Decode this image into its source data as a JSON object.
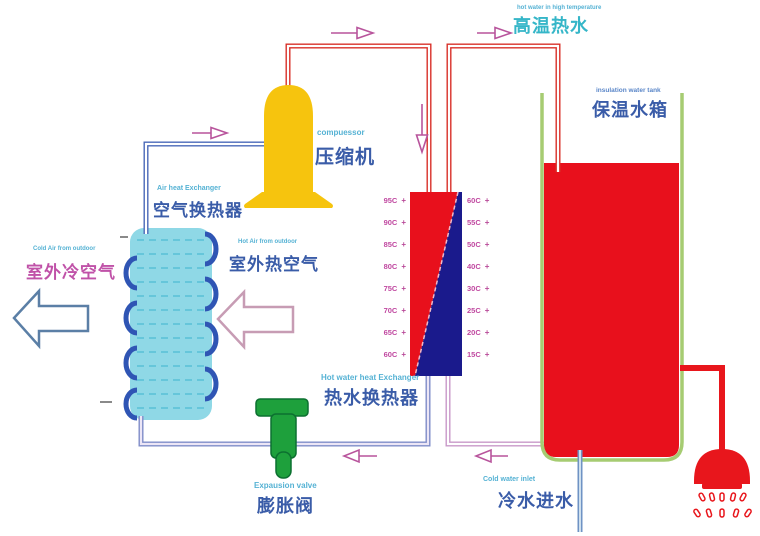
{
  "diagram_title": "heat pump water heater schematic",
  "labels": {
    "compressor": {
      "en": "compuessor",
      "zh": "压缩机"
    },
    "air_heat_exchanger": {
      "en": "Air heat Exchanger",
      "zh": "空气换热器"
    },
    "outdoor_cold_air": {
      "en": "Cold Air from outdoor",
      "zh": "室外冷空气"
    },
    "outdoor_hot_air": {
      "en": "Hot Air from outdoor",
      "zh": "室外热空气"
    },
    "hot_water_exchanger": {
      "en": "Hot water heat Exchanger",
      "zh": "热水换热器"
    },
    "expansion_valve": {
      "en": "Expausion valve",
      "zh": "膨胀阀"
    },
    "cold_water_inlet": {
      "en": "Cold water inlet",
      "zh": "冷水进水"
    },
    "hot_water_outlet": {
      "en": "hot water in high temperature",
      "zh": "高温热水"
    },
    "water_tank": {
      "en": "insulation water tank",
      "zh": "保温水箱"
    }
  },
  "exchanger": {
    "marker": "+",
    "left_temps": [
      "95C",
      "90C",
      "85C",
      "80C",
      "75C",
      "70C",
      "65C",
      "60C"
    ],
    "right_temps": [
      "60C",
      "55C",
      "50C",
      "40C",
      "30C",
      "25C",
      "20C",
      "15C"
    ]
  },
  "colors": {
    "hot_refrigerant_pipe": "#d83028",
    "cold_refrigerant_pipe": "#4a68b8",
    "liquid_line_pipe": "#7f8cc8",
    "water_return_pipe": "#c898c8",
    "cold_water_pipe": "#6f93c4",
    "compressor_body": "#f6c40e",
    "exchanger_hot_side": "#e8101c",
    "exchanger_cold_side": "#1a1a8c",
    "tank_wall": "#a6cc72",
    "tank_water": "#e8101c",
    "valve_body": "#1ea03c",
    "coil_tube": "#8fd8e6",
    "coil_ring": "#2f55b4",
    "flow_arrow": "#b8549c",
    "cold_air_arrow_outline": "#5b7fa6",
    "hot_air_arrow_outline": "#c79cb4"
  }
}
